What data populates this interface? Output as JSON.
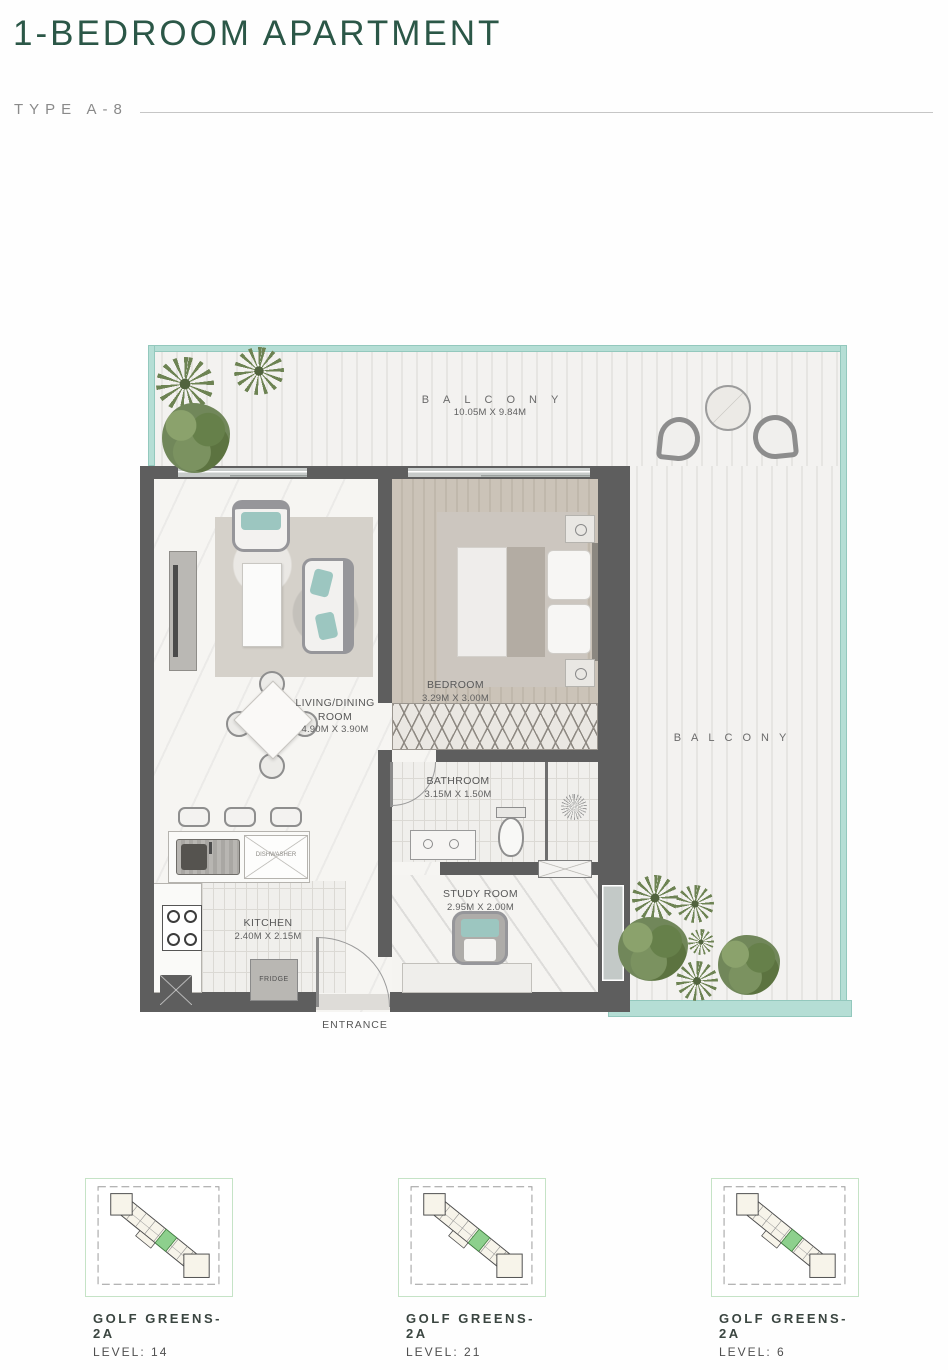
{
  "header": {
    "title": "1-BEDROOM APARTMENT",
    "type_label": "TYPE A-8"
  },
  "floorplan": {
    "balcony_top": {
      "label": "BALCONY",
      "dims": "10.05M X 9.84M"
    },
    "balcony_right": {
      "label": "BALCONY"
    },
    "rooms": {
      "living": {
        "label": "LIVING/DINING ROOM",
        "dims": "4.90M X 3.90M"
      },
      "bedroom": {
        "label": "BEDROOM",
        "dims": "3.29M X 3.00M"
      },
      "bathroom": {
        "label": "BATHROOM",
        "dims": "3.15M X 1.50M"
      },
      "kitchen": {
        "label": "KITCHEN",
        "dims": "2.40M X 2.15M"
      },
      "study": {
        "label": "STUDY ROOM",
        "dims": "2.95M X 2.00M"
      }
    },
    "annotations": {
      "entrance": "ENTRANCE",
      "fridge": "FRIDGE",
      "dishwasher": "DISHWASHER"
    }
  },
  "keyplans": [
    {
      "building": "GOLF GREENS-2A",
      "level": "LEVEL: 14"
    },
    {
      "building": "GOLF GREENS-2A",
      "level": "LEVEL: 21"
    },
    {
      "building": "GOLF GREENS-2A",
      "level": "LEVEL: 6"
    }
  ],
  "colors": {
    "title_green": "#2b5747",
    "railing_teal": "#b5ded5",
    "wall_gray": "#5e5e5e",
    "unit_highlight_green": "#8dd08d"
  }
}
